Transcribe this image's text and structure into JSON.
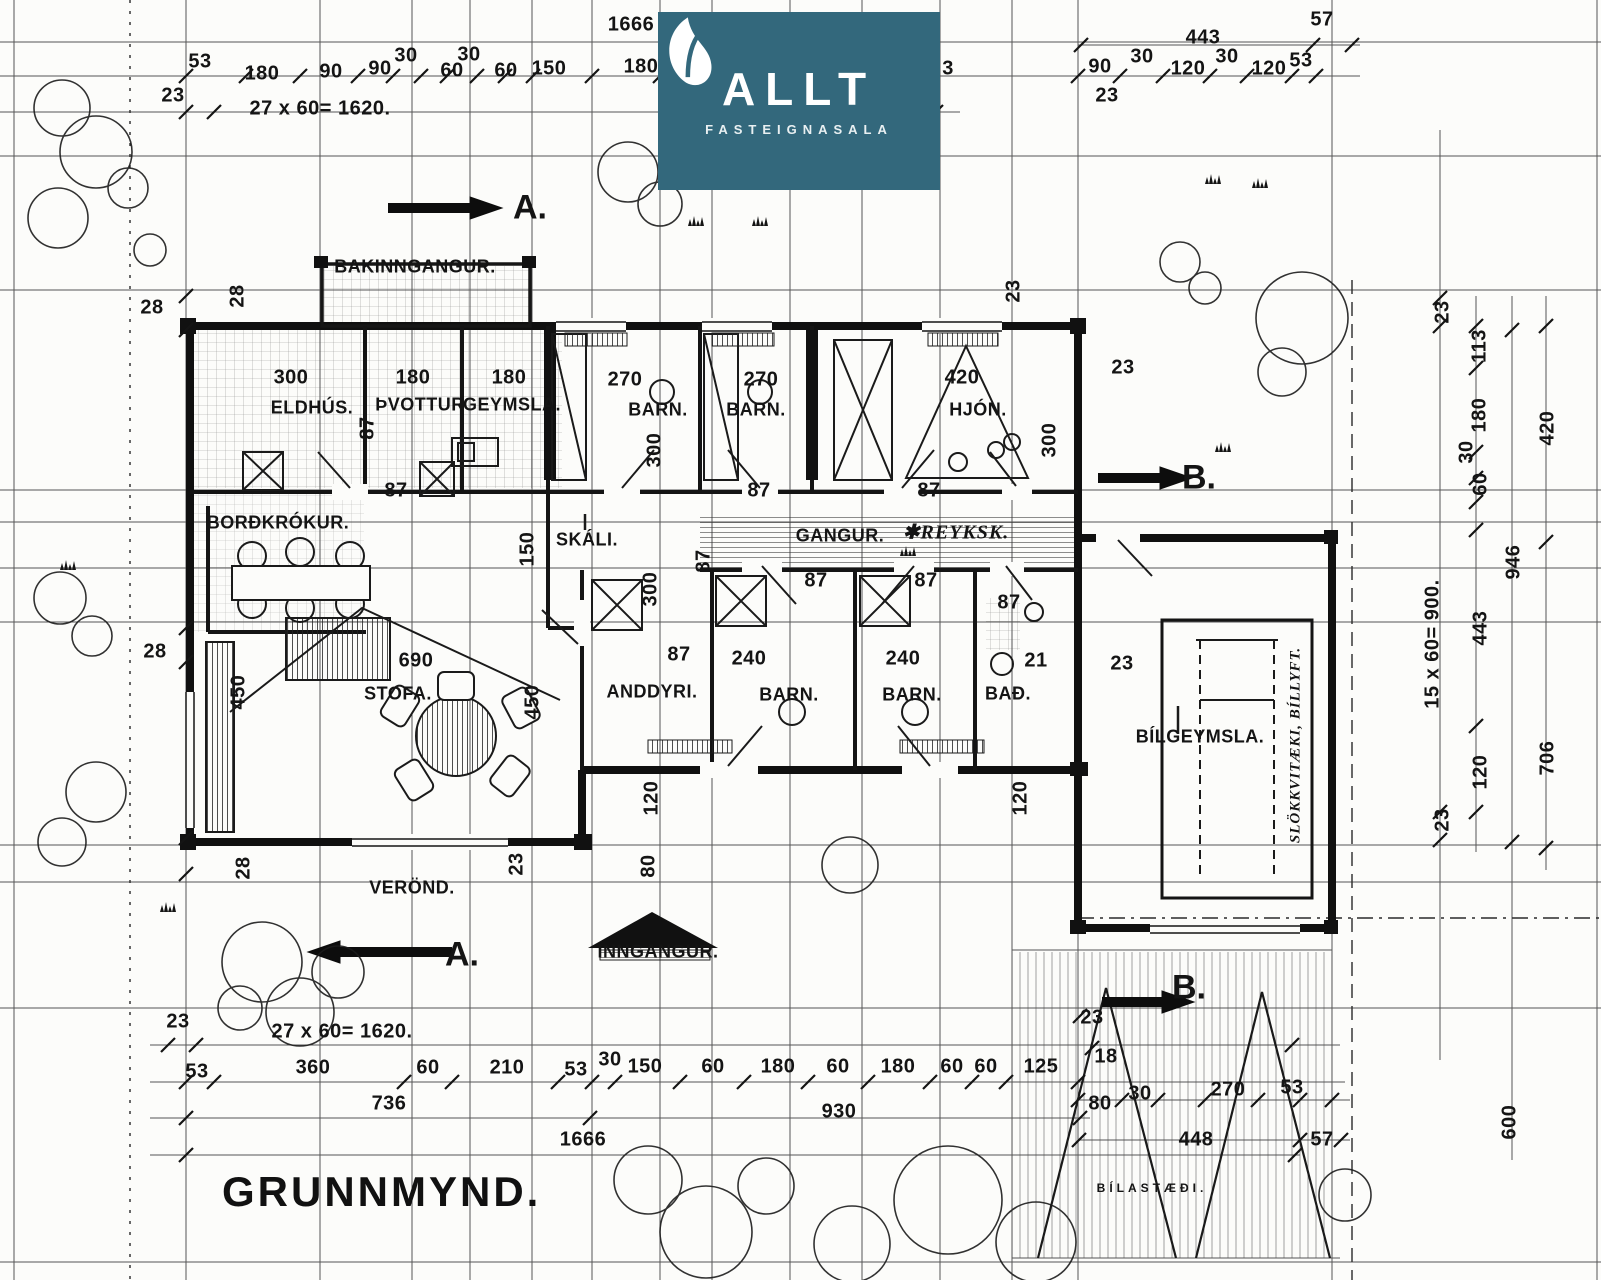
{
  "logo": {
    "brand": "ALLT",
    "subtitle": "FASTEIGNASALA",
    "bg": "#33687c",
    "icon": "leaf-icon"
  },
  "title": {
    "text": "GRUNNMYND."
  },
  "labels": [
    {
      "n": "room-label-bakinngangur",
      "t": "BAKINNGANGUR.",
      "x": 415,
      "y": 267,
      "c": "room"
    },
    {
      "n": "room-label-eldhus",
      "t": "ELDHÚS.",
      "x": 312,
      "y": 408,
      "c": "room"
    },
    {
      "n": "room-label-thvottur",
      "t": "ÞVOTTUR",
      "x": 420,
      "y": 405,
      "c": "room"
    },
    {
      "n": "room-label-geymsla",
      "t": "GEYMSLA.",
      "x": 512,
      "y": 405,
      "c": "room"
    },
    {
      "n": "room-label-barn-1",
      "t": "BARN.",
      "x": 658,
      "y": 410,
      "c": "room"
    },
    {
      "n": "room-label-barn-2",
      "t": "BARN.",
      "x": 756,
      "y": 410,
      "c": "room"
    },
    {
      "n": "room-label-hjon",
      "t": "HJÓN.",
      "x": 978,
      "y": 410,
      "c": "room"
    },
    {
      "n": "room-label-bordkrokur",
      "t": "BORÐKRÓKUR.",
      "x": 278,
      "y": 523,
      "c": "room"
    },
    {
      "n": "room-label-skali",
      "t": "SKÁLI.",
      "x": 587,
      "y": 540,
      "c": "room"
    },
    {
      "n": "room-label-gangur",
      "t": "GANGUR.",
      "x": 840,
      "y": 536,
      "c": "room"
    },
    {
      "n": "room-label-stofa",
      "t": "STOFA.",
      "x": 398,
      "y": 694,
      "c": "room"
    },
    {
      "n": "room-label-anddyri",
      "t": "ANDDYRI.",
      "x": 652,
      "y": 692,
      "c": "room"
    },
    {
      "n": "room-label-barn-3",
      "t": "BARN.",
      "x": 789,
      "y": 695,
      "c": "room"
    },
    {
      "n": "room-label-barn-4",
      "t": "BARN.",
      "x": 912,
      "y": 695,
      "c": "room"
    },
    {
      "n": "room-label-bad",
      "t": "BAÐ.",
      "x": 1008,
      "y": 694,
      "c": "room"
    },
    {
      "n": "room-label-bilgeymsla",
      "t": "BÍLGEYMSLA.",
      "x": 1200,
      "y": 737,
      "c": "room"
    },
    {
      "n": "room-label-verond",
      "t": "VERÖND.",
      "x": 412,
      "y": 888,
      "c": "room"
    },
    {
      "n": "room-label-inngangur",
      "t": "INNGANGUR.",
      "x": 658,
      "y": 952,
      "c": "room"
    },
    {
      "n": "room-label-bilastaedi",
      "t": "BÍLASTÆÐI.",
      "x": 1152,
      "y": 1188,
      "c": "tiny"
    },
    {
      "n": "section-marker-a-top",
      "t": "A.",
      "x": 530,
      "y": 208,
      "c": "marker"
    },
    {
      "n": "section-marker-a-bottom",
      "t": "A.",
      "x": 462,
      "y": 955,
      "c": "marker"
    },
    {
      "n": "section-marker-b-right",
      "t": "B.",
      "x": 1199,
      "y": 478,
      "c": "marker"
    },
    {
      "n": "section-marker-b-bottom",
      "t": "B.",
      "x": 1189,
      "y": 988,
      "c": "marker"
    },
    {
      "n": "note-reykskynjari",
      "t": "✱REYKSK.",
      "x": 956,
      "y": 532,
      "c": "hand"
    },
    {
      "n": "note-slokkvitaeki",
      "t": "SLÖKKVITÆKI, BÍLLYFT.",
      "x": 1296,
      "y": 745,
      "c": "hand",
      "r": -90,
      "s": 15
    },
    {
      "n": "dim",
      "t": "1666",
      "x": 631,
      "y": 25
    },
    {
      "n": "dim",
      "t": "53",
      "x": 200,
      "y": 62
    },
    {
      "n": "dim",
      "t": "180",
      "x": 262,
      "y": 74
    },
    {
      "n": "dim",
      "t": "90",
      "x": 331,
      "y": 72
    },
    {
      "n": "dim",
      "t": "90",
      "x": 380,
      "y": 69
    },
    {
      "n": "dim",
      "t": "30",
      "x": 406,
      "y": 56
    },
    {
      "n": "dim",
      "t": "60",
      "x": 452,
      "y": 71
    },
    {
      "n": "dim",
      "t": "30",
      "x": 469,
      "y": 55
    },
    {
      "n": "dim",
      "t": "60",
      "x": 506,
      "y": 71
    },
    {
      "n": "dim",
      "t": "150",
      "x": 549,
      "y": 69
    },
    {
      "n": "dim",
      "t": "180",
      "x": 641,
      "y": 67
    },
    {
      "n": "dim",
      "t": "3",
      "x": 948,
      "y": 69
    },
    {
      "n": "dim",
      "t": "23",
      "x": 173,
      "y": 96
    },
    {
      "n": "dim",
      "t": "27 x 60= 1620.",
      "x": 320,
      "y": 109
    },
    {
      "n": "dim",
      "t": "443",
      "x": 1203,
      "y": 38
    },
    {
      "n": "dim",
      "t": "57",
      "x": 1322,
      "y": 20
    },
    {
      "n": "dim",
      "t": "90",
      "x": 1100,
      "y": 67
    },
    {
      "n": "dim",
      "t": "30",
      "x": 1142,
      "y": 57
    },
    {
      "n": "dim",
      "t": "120",
      "x": 1188,
      "y": 69
    },
    {
      "n": "dim",
      "t": "30",
      "x": 1227,
      "y": 57
    },
    {
      "n": "dim",
      "t": "120",
      "x": 1269,
      "y": 69
    },
    {
      "n": "dim",
      "t": "53",
      "x": 1301,
      "y": 61
    },
    {
      "n": "dim",
      "t": "23",
      "x": 1107,
      "y": 96
    },
    {
      "n": "dim",
      "t": "28",
      "x": 152,
      "y": 308
    },
    {
      "n": "dim",
      "t": "28",
      "x": 238,
      "y": 296,
      "r": -90
    },
    {
      "n": "dim",
      "t": "28",
      "x": 155,
      "y": 652
    },
    {
      "n": "dim",
      "t": "28",
      "x": 244,
      "y": 868,
      "r": -90
    },
    {
      "n": "dim",
      "t": "23",
      "x": 517,
      "y": 864,
      "r": -90
    },
    {
      "n": "dim",
      "t": "300",
      "x": 291,
      "y": 378
    },
    {
      "n": "dim",
      "t": "180",
      "x": 413,
      "y": 378
    },
    {
      "n": "dim",
      "t": "180",
      "x": 509,
      "y": 378
    },
    {
      "n": "dim",
      "t": "270",
      "x": 625,
      "y": 380
    },
    {
      "n": "dim",
      "t": "270",
      "x": 761,
      "y": 380
    },
    {
      "n": "dim",
      "t": "420",
      "x": 962,
      "y": 378
    },
    {
      "n": "dim",
      "t": "87",
      "x": 368,
      "y": 428,
      "r": -90
    },
    {
      "n": "dim",
      "t": "300",
      "x": 655,
      "y": 450,
      "r": -90
    },
    {
      "n": "dim",
      "t": "300",
      "x": 1050,
      "y": 440,
      "r": -90
    },
    {
      "n": "dim",
      "t": "87",
      "x": 396,
      "y": 491
    },
    {
      "n": "dim",
      "t": "87",
      "x": 759,
      "y": 491
    },
    {
      "n": "dim",
      "t": "87",
      "x": 929,
      "y": 491
    },
    {
      "n": "dim",
      "t": "23",
      "x": 1014,
      "y": 291,
      "r": -90
    },
    {
      "n": "dim",
      "t": "23",
      "x": 1123,
      "y": 368
    },
    {
      "n": "dim",
      "t": "150",
      "x": 528,
      "y": 549,
      "r": -90
    },
    {
      "n": "dim",
      "t": "300",
      "x": 651,
      "y": 589,
      "r": -90
    },
    {
      "n": "dim",
      "t": "87",
      "x": 704,
      "y": 561,
      "r": -90
    },
    {
      "n": "dim",
      "t": "87",
      "x": 816,
      "y": 581
    },
    {
      "n": "dim",
      "t": "87",
      "x": 926,
      "y": 581
    },
    {
      "n": "dim",
      "t": "87",
      "x": 1009,
      "y": 603
    },
    {
      "n": "dim",
      "t": "23",
      "x": 1122,
      "y": 664
    },
    {
      "n": "dim",
      "t": "690",
      "x": 416,
      "y": 661
    },
    {
      "n": "dim",
      "t": "450",
      "x": 239,
      "y": 692,
      "r": -90
    },
    {
      "n": "dim",
      "t": "450",
      "x": 533,
      "y": 702,
      "r": -90
    },
    {
      "n": "dim",
      "t": "87",
      "x": 679,
      "y": 655
    },
    {
      "n": "dim",
      "t": "240",
      "x": 749,
      "y": 659
    },
    {
      "n": "dim",
      "t": "240",
      "x": 903,
      "y": 659
    },
    {
      "n": "dim",
      "t": "21",
      "x": 1036,
      "y": 661
    },
    {
      "n": "dim",
      "t": "120",
      "x": 652,
      "y": 798,
      "r": -90
    },
    {
      "n": "dim",
      "t": "120",
      "x": 1021,
      "y": 798,
      "r": -90
    },
    {
      "n": "dim",
      "t": "80",
      "x": 649,
      "y": 866,
      "r": -90
    },
    {
      "n": "dim",
      "t": "23",
      "x": 178,
      "y": 1022
    },
    {
      "n": "dim",
      "t": "27 x 60= 1620.",
      "x": 342,
      "y": 1032
    },
    {
      "n": "dim",
      "t": "53",
      "x": 197,
      "y": 1072
    },
    {
      "n": "dim",
      "t": "360",
      "x": 313,
      "y": 1068
    },
    {
      "n": "dim",
      "t": "60",
      "x": 428,
      "y": 1068
    },
    {
      "n": "dim",
      "t": "210",
      "x": 507,
      "y": 1068
    },
    {
      "n": "dim",
      "t": "53",
      "x": 576,
      "y": 1070
    },
    {
      "n": "dim",
      "t": "30",
      "x": 610,
      "y": 1060
    },
    {
      "n": "dim",
      "t": "150",
      "x": 645,
      "y": 1067
    },
    {
      "n": "dim",
      "t": "60",
      "x": 713,
      "y": 1067
    },
    {
      "n": "dim",
      "t": "180",
      "x": 778,
      "y": 1067
    },
    {
      "n": "dim",
      "t": "60",
      "x": 838,
      "y": 1067
    },
    {
      "n": "dim",
      "t": "180",
      "x": 898,
      "y": 1067
    },
    {
      "n": "dim",
      "t": "60",
      "x": 952,
      "y": 1067
    },
    {
      "n": "dim",
      "t": "60",
      "x": 986,
      "y": 1067
    },
    {
      "n": "dim",
      "t": "125",
      "x": 1041,
      "y": 1067
    },
    {
      "n": "dim",
      "t": "736",
      "x": 389,
      "y": 1104
    },
    {
      "n": "dim",
      "t": "930",
      "x": 839,
      "y": 1112
    },
    {
      "n": "dim",
      "t": "1666",
      "x": 583,
      "y": 1140
    },
    {
      "n": "dim",
      "t": "23",
      "x": 1092,
      "y": 1018
    },
    {
      "n": "dim",
      "t": "18",
      "x": 1106,
      "y": 1057
    },
    {
      "n": "dim",
      "t": "80",
      "x": 1100,
      "y": 1104
    },
    {
      "n": "dim",
      "t": "30",
      "x": 1140,
      "y": 1094
    },
    {
      "n": "dim",
      "t": "270",
      "x": 1228,
      "y": 1090
    },
    {
      "n": "dim",
      "t": "53",
      "x": 1292,
      "y": 1088
    },
    {
      "n": "dim",
      "t": "448",
      "x": 1196,
      "y": 1140
    },
    {
      "n": "dim",
      "t": "57",
      "x": 1322,
      "y": 1140
    },
    {
      "n": "dim",
      "t": "600",
      "x": 1510,
      "y": 1122,
      "r": -90
    },
    {
      "n": "dim",
      "t": "23",
      "x": 1443,
      "y": 312,
      "r": -90
    },
    {
      "n": "dim",
      "t": "113",
      "x": 1480,
      "y": 346,
      "r": -90
    },
    {
      "n": "dim",
      "t": "180",
      "x": 1480,
      "y": 415,
      "r": -90
    },
    {
      "n": "dim",
      "t": "30",
      "x": 1467,
      "y": 452,
      "r": -90
    },
    {
      "n": "dim",
      "t": "60",
      "x": 1481,
      "y": 484,
      "r": -90
    },
    {
      "n": "dim",
      "t": "15 x 60= 900.",
      "x": 1433,
      "y": 644,
      "r": -90
    },
    {
      "n": "dim",
      "t": "443",
      "x": 1481,
      "y": 628,
      "r": -90
    },
    {
      "n": "dim",
      "t": "120",
      "x": 1481,
      "y": 772,
      "r": -90
    },
    {
      "n": "dim",
      "t": "23",
      "x": 1443,
      "y": 820,
      "r": -90
    },
    {
      "n": "dim",
      "t": "420",
      "x": 1548,
      "y": 428,
      "r": -90
    },
    {
      "n": "dim",
      "t": "946",
      "x": 1514,
      "y": 562,
      "r": -90
    },
    {
      "n": "dim",
      "t": "706",
      "x": 1548,
      "y": 758,
      "r": -90
    }
  ]
}
